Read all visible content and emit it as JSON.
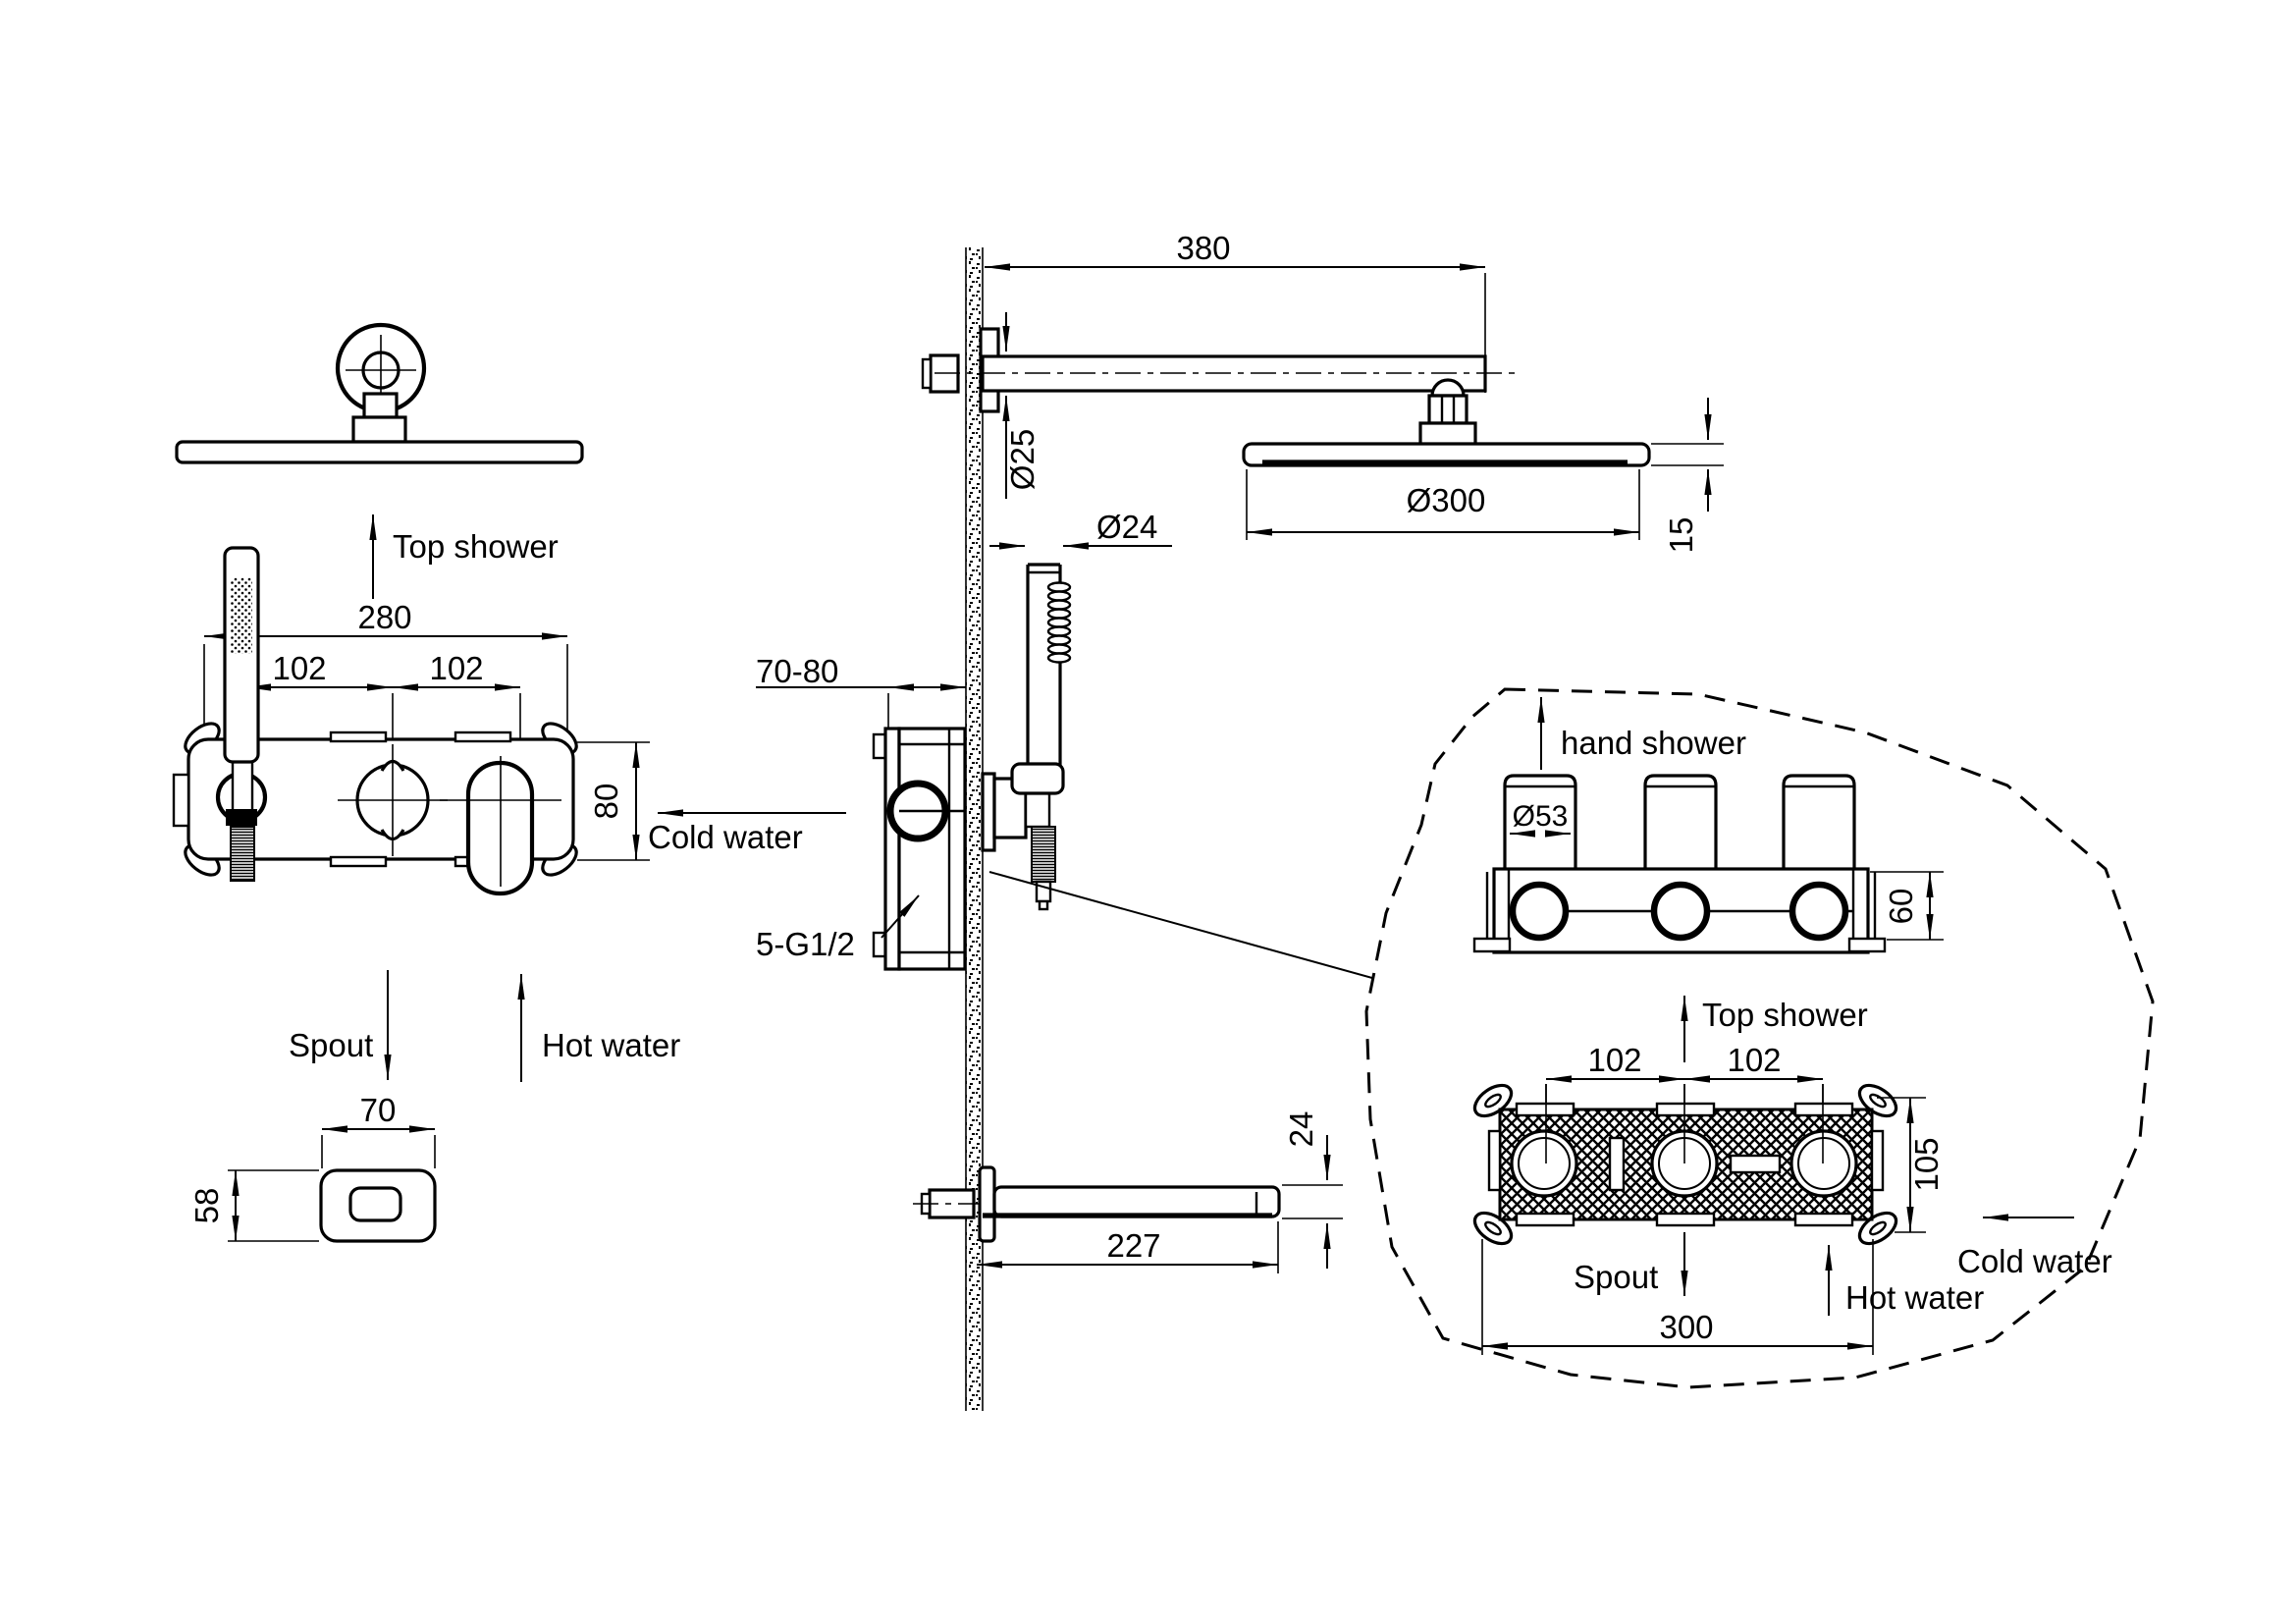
{
  "title": "Concealed shower system installation drawing",
  "colors": {
    "line": "#000000",
    "background": "#ffffff"
  },
  "front_view": {
    "label_top_shower": "Top shower",
    "label_cold_water": "Cold water",
    "label_spout": "Spout",
    "label_hot_water": "Hot water",
    "dim_width": "280",
    "dim_left_spacing": "102",
    "dim_right_spacing": "102",
    "dim_height": "80",
    "spout_detail": {
      "dim_width": "70",
      "dim_height": "58"
    }
  },
  "section_view": {
    "dim_arm_length": "380",
    "dim_arm_diameter": "Ø25",
    "dim_hand_shower_diameter": "Ø24",
    "dim_head_diameter": "Ø300",
    "dim_head_thickness": "15",
    "dim_wall_depth": "70-80",
    "label_connections": "5-G1/2",
    "dim_spout_length": "227",
    "dim_spout_height": "24"
  },
  "detail_view": {
    "label_hand_shower": "hand shower",
    "dim_knob_diameter": "Ø53",
    "dim_box_height": "60",
    "label_top_shower": "Top shower",
    "dim_left_spacing": "102",
    "dim_right_spacing": "102",
    "dim_box_front_height": "105",
    "label_cold_water": "Cold water",
    "label_spout": "Spout",
    "label_hot_water": "Hot water",
    "dim_box_width": "300"
  }
}
